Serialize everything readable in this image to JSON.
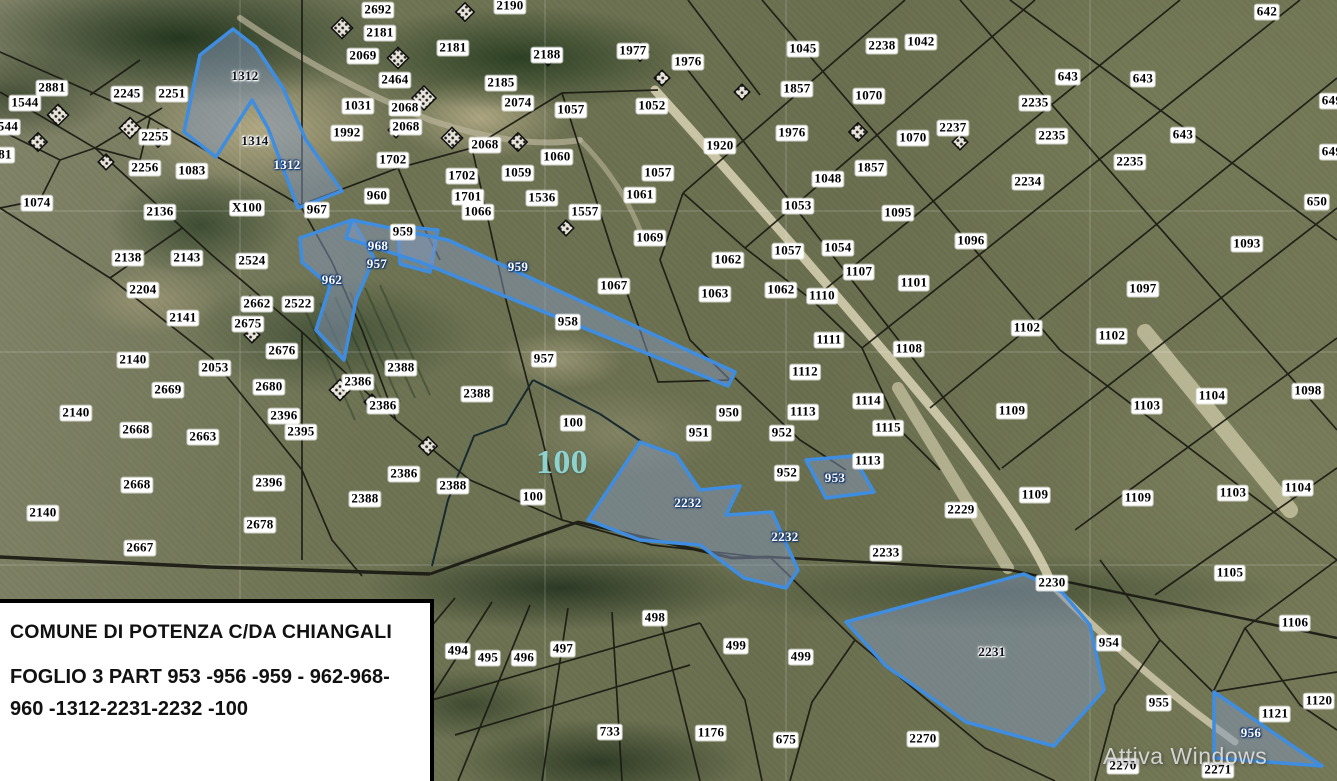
{
  "map": {
    "info_box": {
      "line1": "COMUNE DI POTENZA C/DA CHIANGALI",
      "line2": "FOGLIO 3 PART 953 -956 -959 - 962-968-",
      "line3": "960 -1312-2231-2232 -100",
      "highlighted_parcels": [
        "953",
        "956",
        "959",
        "962",
        "968",
        "960",
        "1312",
        "2231",
        "2232",
        "100"
      ]
    },
    "watermark": "Attiva Windows",
    "colors": {
      "highlight_stroke": "#3e8de0",
      "highlight_fill": "rgba(130,150,185,0.5)",
      "boundary": "#1a1a12",
      "label_chip": "#ffffff",
      "big_label": "#8ed2d0"
    },
    "labels": [
      {
        "t": "2692",
        "x": 378,
        "y": 10
      },
      {
        "t": "2190",
        "x": 510,
        "y": 6
      },
      {
        "t": "2181",
        "x": 380,
        "y": 33
      },
      {
        "t": "2069",
        "x": 363,
        "y": 56
      },
      {
        "t": "2181",
        "x": 453,
        "y": 48
      },
      {
        "t": "2188",
        "x": 547,
        "y": 55
      },
      {
        "t": "1977",
        "x": 633,
        "y": 51
      },
      {
        "t": "1976",
        "x": 688,
        "y": 62
      },
      {
        "t": "1045",
        "x": 803,
        "y": 49
      },
      {
        "t": "2238",
        "x": 882,
        "y": 46
      },
      {
        "t": "1042",
        "x": 921,
        "y": 42
      },
      {
        "t": "642",
        "x": 1267,
        "y": 12
      },
      {
        "t": "643",
        "x": 1068,
        "y": 77
      },
      {
        "t": "643",
        "x": 1143,
        "y": 79
      },
      {
        "t": "649",
        "x": 1332,
        "y": 101
      },
      {
        "t": "2881",
        "x": 52,
        "y": 88
      },
      {
        "t": "2245",
        "x": 127,
        "y": 94
      },
      {
        "t": "2251",
        "x": 172,
        "y": 94
      },
      {
        "t": "1544",
        "x": 25,
        "y": 103
      },
      {
        "t": "544",
        "x": 8,
        "y": 127
      },
      {
        "t": "81",
        "x": 5,
        "y": 155
      },
      {
        "t": "2464",
        "x": 395,
        "y": 80
      },
      {
        "t": "2185",
        "x": 501,
        "y": 83
      },
      {
        "t": "1031",
        "x": 358,
        "y": 106
      },
      {
        "t": "2068",
        "x": 405,
        "y": 108
      },
      {
        "t": "2074",
        "x": 518,
        "y": 103
      },
      {
        "t": "1057",
        "x": 571,
        "y": 110
      },
      {
        "t": "1052",
        "x": 652,
        "y": 106
      },
      {
        "t": "1992",
        "x": 347,
        "y": 133
      },
      {
        "t": "2068",
        "x": 406,
        "y": 127
      },
      {
        "t": "1857",
        "x": 797,
        "y": 89
      },
      {
        "t": "1070",
        "x": 869,
        "y": 96
      },
      {
        "t": "2237",
        "x": 953,
        "y": 128
      },
      {
        "t": "1976",
        "x": 792,
        "y": 133
      },
      {
        "t": "1920",
        "x": 720,
        "y": 146
      },
      {
        "t": "1070",
        "x": 913,
        "y": 138
      },
      {
        "t": "2235",
        "x": 1035,
        "y": 103
      },
      {
        "t": "2235",
        "x": 1052,
        "y": 136
      },
      {
        "t": "643",
        "x": 1183,
        "y": 135
      },
      {
        "t": "2235",
        "x": 1130,
        "y": 162
      },
      {
        "t": "649",
        "x": 1332,
        "y": 152
      },
      {
        "t": "2234",
        "x": 1028,
        "y": 182
      },
      {
        "t": "2255",
        "x": 155,
        "y": 137
      },
      {
        "t": "2256",
        "x": 145,
        "y": 168
      },
      {
        "t": "1083",
        "x": 192,
        "y": 171
      },
      {
        "t": "1702",
        "x": 393,
        "y": 160
      },
      {
        "t": "2068",
        "x": 485,
        "y": 145
      },
      {
        "t": "1060",
        "x": 557,
        "y": 157
      },
      {
        "t": "1702",
        "x": 462,
        "y": 176
      },
      {
        "t": "1059",
        "x": 518,
        "y": 173
      },
      {
        "t": "1057",
        "x": 658,
        "y": 173
      },
      {
        "t": "1857",
        "x": 871,
        "y": 168
      },
      {
        "t": "1048",
        "x": 828,
        "y": 179
      },
      {
        "t": "650",
        "x": 1317,
        "y": 202
      },
      {
        "t": "1093",
        "x": 1247,
        "y": 244
      },
      {
        "t": "1074",
        "x": 37,
        "y": 203
      },
      {
        "t": "2136",
        "x": 160,
        "y": 212
      },
      {
        "t": "X100",
        "x": 247,
        "y": 208
      },
      {
        "t": "967",
        "x": 317,
        "y": 210
      },
      {
        "t": "960",
        "x": 377,
        "y": 196
      },
      {
        "t": "1701",
        "x": 468,
        "y": 197
      },
      {
        "t": "1536",
        "x": 542,
        "y": 198
      },
      {
        "t": "1061",
        "x": 640,
        "y": 195
      },
      {
        "t": "1066",
        "x": 478,
        "y": 212
      },
      {
        "t": "1557",
        "x": 585,
        "y": 212
      },
      {
        "t": "959",
        "x": 403,
        "y": 232
      },
      {
        "t": "1069",
        "x": 650,
        "y": 238
      },
      {
        "t": "1053",
        "x": 798,
        "y": 206
      },
      {
        "t": "1095",
        "x": 898,
        "y": 213
      },
      {
        "t": "1057",
        "x": 788,
        "y": 251
      },
      {
        "t": "1054",
        "x": 838,
        "y": 248
      },
      {
        "t": "1096",
        "x": 971,
        "y": 241
      },
      {
        "t": "2138",
        "x": 128,
        "y": 258
      },
      {
        "t": "2143",
        "x": 187,
        "y": 258
      },
      {
        "t": "2524",
        "x": 252,
        "y": 261
      },
      {
        "t": "1062",
        "x": 728,
        "y": 260
      },
      {
        "t": "1107",
        "x": 859,
        "y": 272
      },
      {
        "t": "1101",
        "x": 914,
        "y": 283
      },
      {
        "t": "2204",
        "x": 143,
        "y": 290
      },
      {
        "t": "1063",
        "x": 715,
        "y": 294
      },
      {
        "t": "1062",
        "x": 781,
        "y": 290
      },
      {
        "t": "1110",
        "x": 822,
        "y": 296
      },
      {
        "t": "1067",
        "x": 614,
        "y": 286
      },
      {
        "t": "2662",
        "x": 257,
        "y": 304
      },
      {
        "t": "2522",
        "x": 298,
        "y": 304
      },
      {
        "t": "1097",
        "x": 1143,
        "y": 289
      },
      {
        "t": "2141",
        "x": 183,
        "y": 318
      },
      {
        "t": "2675",
        "x": 248,
        "y": 324
      },
      {
        "t": "1111",
        "x": 829,
        "y": 340
      },
      {
        "t": "1108",
        "x": 909,
        "y": 349
      },
      {
        "t": "1102",
        "x": 1027,
        "y": 328
      },
      {
        "t": "1102",
        "x": 1112,
        "y": 336
      },
      {
        "t": "958",
        "x": 568,
        "y": 322
      },
      {
        "t": "2676",
        "x": 282,
        "y": 351
      },
      {
        "t": "2140",
        "x": 133,
        "y": 360
      },
      {
        "t": "2053",
        "x": 215,
        "y": 368
      },
      {
        "t": "1112",
        "x": 805,
        "y": 372
      },
      {
        "t": "957",
        "x": 544,
        "y": 359
      },
      {
        "t": "2388",
        "x": 401,
        "y": 368
      },
      {
        "t": "2386",
        "x": 358,
        "y": 382
      },
      {
        "t": "2388",
        "x": 477,
        "y": 394
      },
      {
        "t": "2386",
        "x": 383,
        "y": 406
      },
      {
        "t": "2669",
        "x": 168,
        "y": 390
      },
      {
        "t": "2680",
        "x": 269,
        "y": 387
      },
      {
        "t": "2140",
        "x": 76,
        "y": 413
      },
      {
        "t": "2396",
        "x": 284,
        "y": 416
      },
      {
        "t": "2668",
        "x": 136,
        "y": 430
      },
      {
        "t": "2663",
        "x": 203,
        "y": 437
      },
      {
        "t": "2395",
        "x": 301,
        "y": 432
      },
      {
        "t": "100",
        "x": 573,
        "y": 423
      },
      {
        "t": "950",
        "x": 729,
        "y": 413
      },
      {
        "t": "1113",
        "x": 803,
        "y": 412
      },
      {
        "t": "1114",
        "x": 868,
        "y": 401
      },
      {
        "t": "951",
        "x": 699,
        "y": 433
      },
      {
        "t": "952",
        "x": 782,
        "y": 433
      },
      {
        "t": "1115",
        "x": 888,
        "y": 428
      },
      {
        "t": "1109",
        "x": 1012,
        "y": 411
      },
      {
        "t": "1103",
        "x": 1147,
        "y": 406
      },
      {
        "t": "1104",
        "x": 1212,
        "y": 396
      },
      {
        "t": "1098",
        "x": 1308,
        "y": 391
      },
      {
        "t": "1113",
        "x": 868,
        "y": 461
      },
      {
        "t": "952",
        "x": 787,
        "y": 473
      },
      {
        "t": "2396",
        "x": 269,
        "y": 483
      },
      {
        "t": "2668",
        "x": 137,
        "y": 485
      },
      {
        "t": "2386",
        "x": 404,
        "y": 474
      },
      {
        "t": "2388",
        "x": 453,
        "y": 486
      },
      {
        "t": "2388",
        "x": 365,
        "y": 499
      },
      {
        "t": "100",
        "x": 533,
        "y": 497
      },
      {
        "t": "2229",
        "x": 961,
        "y": 510
      },
      {
        "t": "1109",
        "x": 1035,
        "y": 495
      },
      {
        "t": "1109",
        "x": 1138,
        "y": 498
      },
      {
        "t": "1103",
        "x": 1233,
        "y": 493
      },
      {
        "t": "1104",
        "x": 1298,
        "y": 488
      },
      {
        "t": "2140",
        "x": 43,
        "y": 513
      },
      {
        "t": "2678",
        "x": 260,
        "y": 525
      },
      {
        "t": "2233",
        "x": 886,
        "y": 553
      },
      {
        "t": "2667",
        "x": 140,
        "y": 548
      },
      {
        "t": "1105",
        "x": 1230,
        "y": 573
      },
      {
        "t": "2230",
        "x": 1052,
        "y": 583
      },
      {
        "t": "1106",
        "x": 1295,
        "y": 623
      },
      {
        "t": "954",
        "x": 1109,
        "y": 643
      },
      {
        "t": "494",
        "x": 458,
        "y": 651
      },
      {
        "t": "495",
        "x": 488,
        "y": 658
      },
      {
        "t": "496",
        "x": 524,
        "y": 658
      },
      {
        "t": "497",
        "x": 563,
        "y": 649
      },
      {
        "t": "498",
        "x": 655,
        "y": 618
      },
      {
        "t": "499",
        "x": 736,
        "y": 646
      },
      {
        "t": "499",
        "x": 801,
        "y": 657
      },
      {
        "t": "955",
        "x": 1159,
        "y": 703
      },
      {
        "t": "1120",
        "x": 1319,
        "y": 701
      },
      {
        "t": "1121",
        "x": 1275,
        "y": 714
      },
      {
        "t": "733",
        "x": 610,
        "y": 732
      },
      {
        "t": "1176",
        "x": 711,
        "y": 733
      },
      {
        "t": "675",
        "x": 786,
        "y": 740
      },
      {
        "t": "2270",
        "x": 923,
        "y": 739
      },
      {
        "t": "2270",
        "x": 1123,
        "y": 766
      },
      {
        "t": "2271",
        "x": 1218,
        "y": 770
      },
      {
        "t": "1312",
        "x": 245,
        "y": 76,
        "s": "halo"
      },
      {
        "t": "1314",
        "x": 255,
        "y": 141,
        "s": "halo"
      },
      {
        "t": "1312",
        "x": 287,
        "y": 165,
        "s": "blue"
      },
      {
        "t": "968",
        "x": 378,
        "y": 246,
        "s": "blue"
      },
      {
        "t": "957",
        "x": 377,
        "y": 264,
        "s": "blue"
      },
      {
        "t": "962",
        "x": 332,
        "y": 280,
        "s": "blue"
      },
      {
        "t": "959",
        "x": 518,
        "y": 267,
        "s": "blue"
      },
      {
        "t": "953",
        "x": 835,
        "y": 478,
        "s": "blue"
      },
      {
        "t": "2232",
        "x": 688,
        "y": 503,
        "s": "blue"
      },
      {
        "t": "2232",
        "x": 785,
        "y": 537,
        "s": "blue"
      },
      {
        "t": "2231",
        "x": 992,
        "y": 652,
        "s": "halo"
      },
      {
        "t": "956",
        "x": 1251,
        "y": 733,
        "s": "blue"
      },
      {
        "t": "100",
        "x": 562,
        "y": 463,
        "s": "teal"
      }
    ]
  }
}
